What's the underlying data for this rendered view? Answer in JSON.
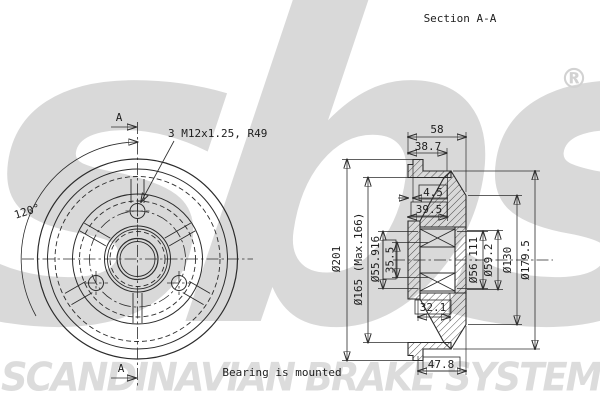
{
  "header": {
    "title": "Section A-A"
  },
  "watermark": {
    "logo": "sbs",
    "registered": "®",
    "banner": "SCANDINAVIAN BRAKE SYSTEMS",
    "color": "#d9d9d9"
  },
  "colors": {
    "line": "#2b2b2b",
    "background": "#ffffff"
  },
  "front_view": {
    "angle_label": "120°",
    "bolt_label": "3 M12x1.25, R49",
    "marker_top": "A",
    "marker_bottom": "A"
  },
  "section_view": {
    "note": "Bearing is mounted",
    "dims": {
      "total_width": "58",
      "flange_width": "38.7",
      "lip_width": "4.5",
      "drum_depth": "39.5",
      "bearing_seat_depth": "32.1",
      "hub_length": "47.8",
      "outer_dia": "Ø201",
      "friction_dia": "Ø165 (Max.166)",
      "seal_dia": "Ø55.916",
      "bore_dia": "35.5",
      "bearing_dia": "Ø56.111",
      "housing_dia": "Ø59.2",
      "flange_dia": "Ø130",
      "shoulder_dia": "Ø179.5"
    }
  }
}
